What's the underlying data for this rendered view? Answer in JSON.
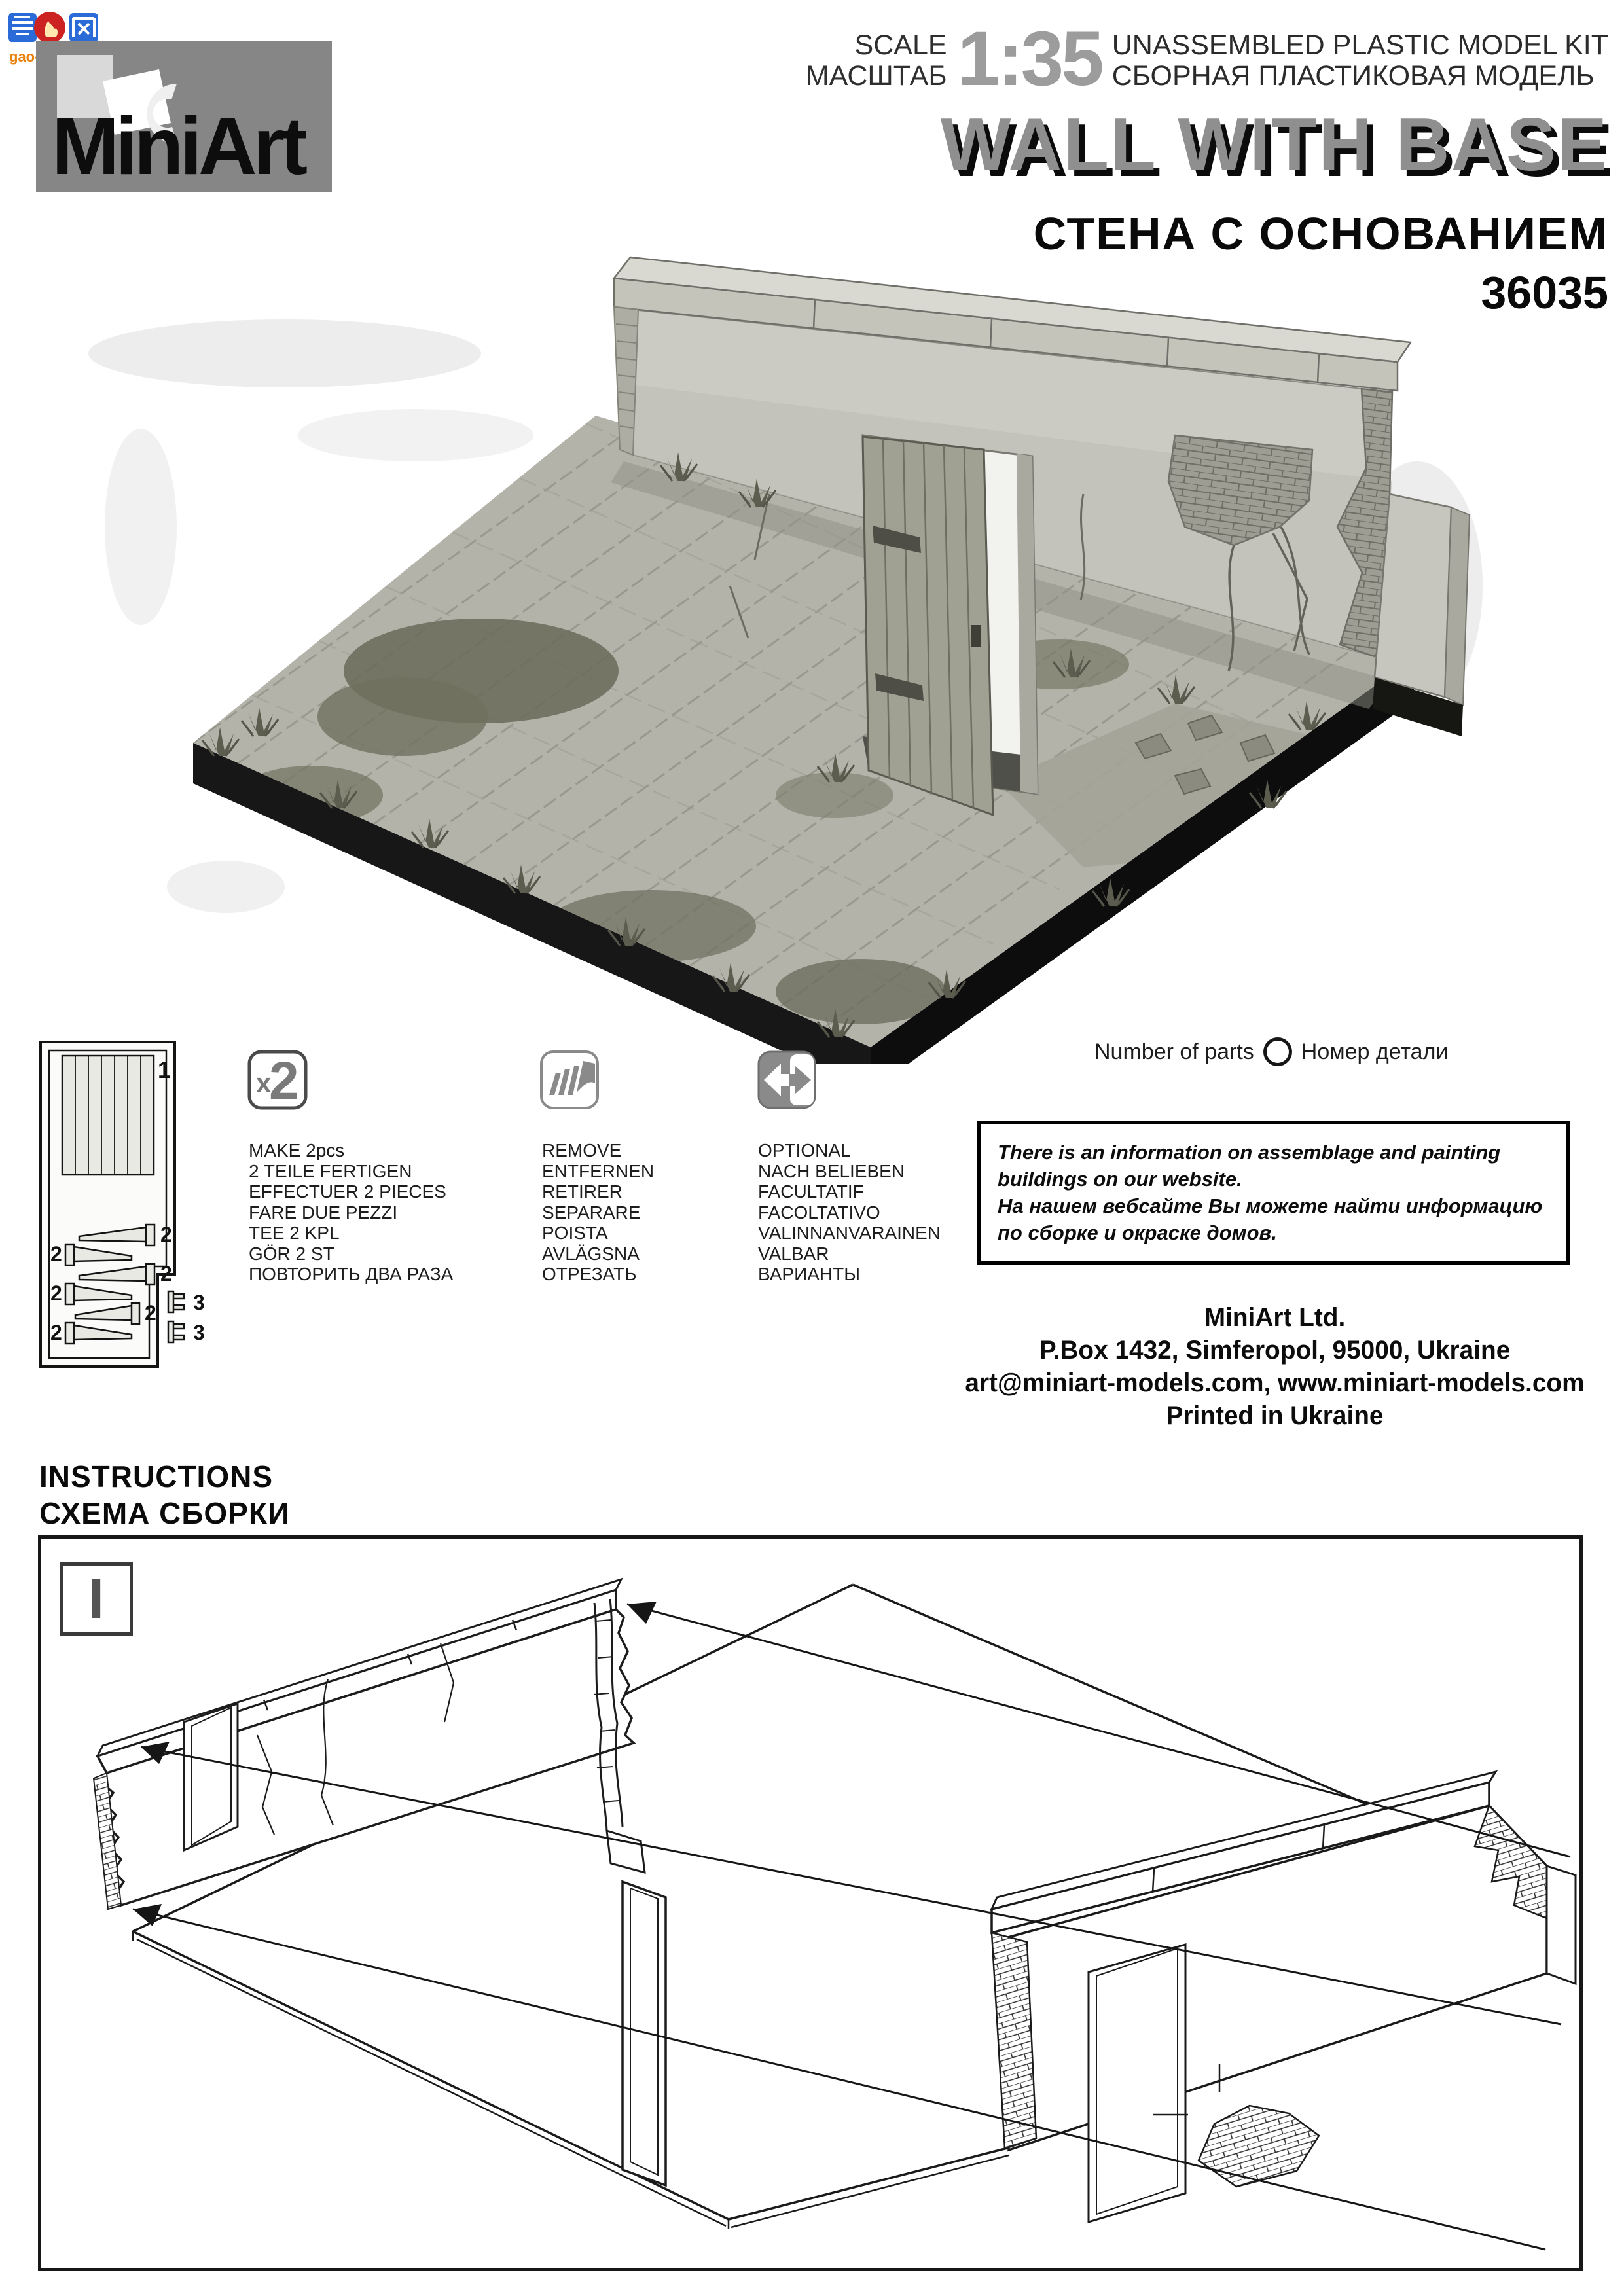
{
  "watermark": {
    "chars": "高网",
    "url": "gao-shou.com"
  },
  "brand": {
    "logo_text": "MiniArt"
  },
  "header": {
    "scale_label_en": "SCALE",
    "scale_label_ru": "МАСШТАБ",
    "scale_value": "1:35",
    "kit_type_en": "UNASSEMBLED PLASTIC MODEL KIT",
    "kit_type_ru": "СБОРНАЯ ПЛАСТИКОВАЯ МОДЕЛЬ",
    "title": "WALL WITH BASE",
    "title_ru": "СТЕНА С ОСНОВАНИЕМ",
    "kit_number": "36035"
  },
  "sprue": {
    "part1": "1",
    "part2": "2",
    "part3": "3"
  },
  "columns": {
    "make": {
      "icon_x": "x",
      "icon_num": "2",
      "lines": [
        "MAKE 2pcs",
        "2 TEILE FERTIGEN",
        "EFFECTUER 2 PIECES",
        "FARE DUE PEZZI",
        "TEE 2 KPL",
        "GÖR 2 ST",
        "ПОВТОРИТЬ ДВА РАЗА"
      ]
    },
    "remove": {
      "lines": [
        "REMOVE",
        "ENTFERNEN",
        "RETIRER",
        "SEPARARE",
        "POISTA",
        "AVLÄGSNA",
        "ОТРЕЗАТЬ"
      ]
    },
    "optional": {
      "lines": [
        "OPTIONAL",
        "NACH BELIEBEN",
        "FACULTATIF",
        "FACOLTATIVO",
        "VALINNANVARAINEN",
        "VALBAR",
        "ВАРИАНТЫ"
      ]
    }
  },
  "parts_note": {
    "en": "Number of parts",
    "ru": "Номер детали"
  },
  "website_note": {
    "lines": [
      "There is an information on assemblage and painting",
      "buildings on our website.",
      "На нашем вебсайте Вы можете найти информацию",
      "по сборке и окраске домов."
    ]
  },
  "company": {
    "lines": [
      "MiniArt Ltd.",
      "P.Box 1432, Simferopol, 95000, Ukraine",
      "art@miniart-models.com, www.miniart-models.com",
      "Printed in Ukraine"
    ]
  },
  "instructions": {
    "en": "INSTRUCTIONS",
    "ru": "СХЕМА СБОРКИ"
  },
  "step": {
    "number": "I"
  },
  "colors": {
    "logo_bg": "#868686",
    "title_gray": "#8f8f8f",
    "scale_gray": "#9c9c9c",
    "text_black": "#111111",
    "watermark_blue": "#2b6bd7",
    "watermark_red": "#cc2222",
    "watermark_orange": "#e8820c"
  }
}
